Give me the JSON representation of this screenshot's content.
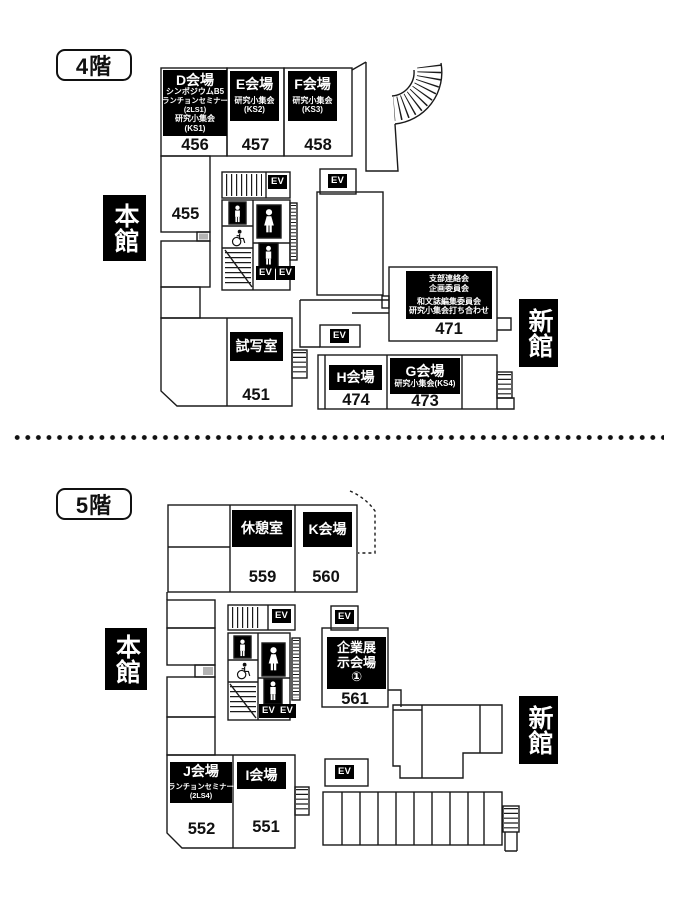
{
  "ev_label": "EV",
  "floor4": {
    "label": "4階",
    "buildings": {
      "main": "本館",
      "new": "新館"
    },
    "rooms": {
      "d": {
        "title": "D会場",
        "lines": [
          "シンポジウムB5",
          "ランチョンセミナー",
          "(2LS1)",
          "研究小集会",
          "(KS1)"
        ],
        "number": "456"
      },
      "e": {
        "title": "E会場",
        "lines": [
          "研究小集会",
          "(KS2)"
        ],
        "number": "457"
      },
      "f": {
        "title": "F会場",
        "lines": [
          "研究小集会",
          "(KS3)"
        ],
        "number": "458"
      },
      "r455": {
        "number": "455"
      },
      "preview": {
        "title": "試写室",
        "number": "451"
      },
      "h": {
        "title": "H会場",
        "number": "474"
      },
      "g": {
        "title": "G会場",
        "lines": [
          "研究小集会(KS4)"
        ],
        "number": "473"
      },
      "meetings": {
        "lines": [
          "支部連絡会",
          "企画委員会",
          "和文誌編集委員会",
          "研究小集会打ち合わせ"
        ],
        "number": "471"
      }
    }
  },
  "floor5": {
    "label": "5階",
    "buildings": {
      "main": "本館",
      "new": "新館"
    },
    "rooms": {
      "rest": {
        "title": "休憩室",
        "number": "559"
      },
      "k": {
        "title": "K会場",
        "number": "560"
      },
      "exhibition": {
        "lines": [
          "企業展",
          "示会場",
          "①"
        ],
        "number": "561"
      },
      "j": {
        "title": "J会場",
        "lines": [
          "ランチョンセミナー",
          "(2LS4)"
        ],
        "number": "552"
      },
      "i": {
        "title": "I会場",
        "number": "551"
      }
    }
  }
}
